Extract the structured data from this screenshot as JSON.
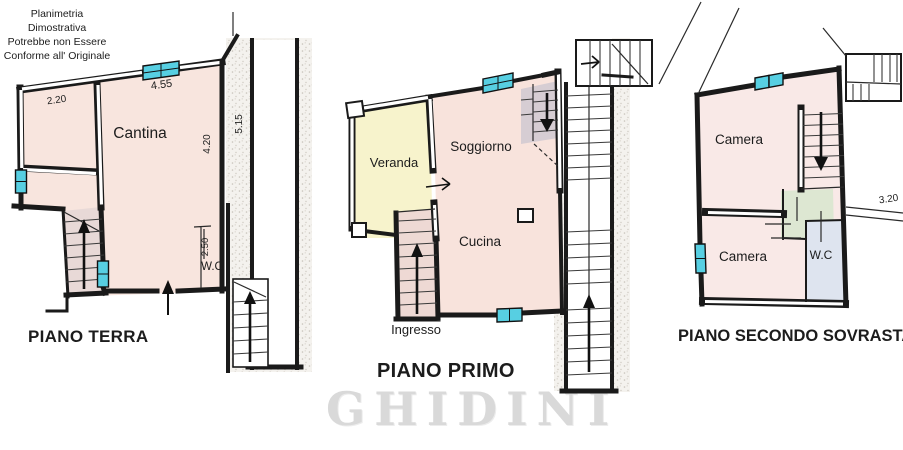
{
  "disclaimer": {
    "line1": "Planimetria",
    "line2": "Dimostrativa",
    "line3": "Potrebbe non Essere",
    "line4": "Conforme all' Originale"
  },
  "watermark": {
    "text": "GHIDINI"
  },
  "plans": {
    "terra": {
      "title": "PIANO TERRA",
      "rooms": {
        "cantina": "Cantina",
        "wc": "W.C"
      },
      "dims": {
        "d220": "2.20",
        "d455": "4.55",
        "d420": "4.20",
        "d515": "5.15",
        "d250": "2.50"
      }
    },
    "primo": {
      "title": "PIANO PRIMO",
      "rooms": {
        "veranda": "Veranda",
        "soggiorno": "Soggiorno",
        "cucina": "Cucina",
        "ingresso": "Ingresso"
      }
    },
    "secondo": {
      "title": "PIANO SECONDO SOVRASTANTE",
      "rooms": {
        "camera_top": "Camera",
        "camera_bottom": "Camera",
        "wc": "W.C"
      },
      "dims": {
        "d320": "3.20"
      }
    }
  },
  "colors": {
    "room_pink": "#f8e5de",
    "room_pink_light": "#f9e9e7",
    "veranda_yellow": "#f7f3cc",
    "stair_pink": "#eed9d4",
    "stair_gray": "#d6cdd3",
    "wc_blue": "#dee4ef",
    "hall_green": "#dde7d2",
    "window_cyan": "#57cfe2",
    "watermark_gray": "#d9d9d9"
  }
}
